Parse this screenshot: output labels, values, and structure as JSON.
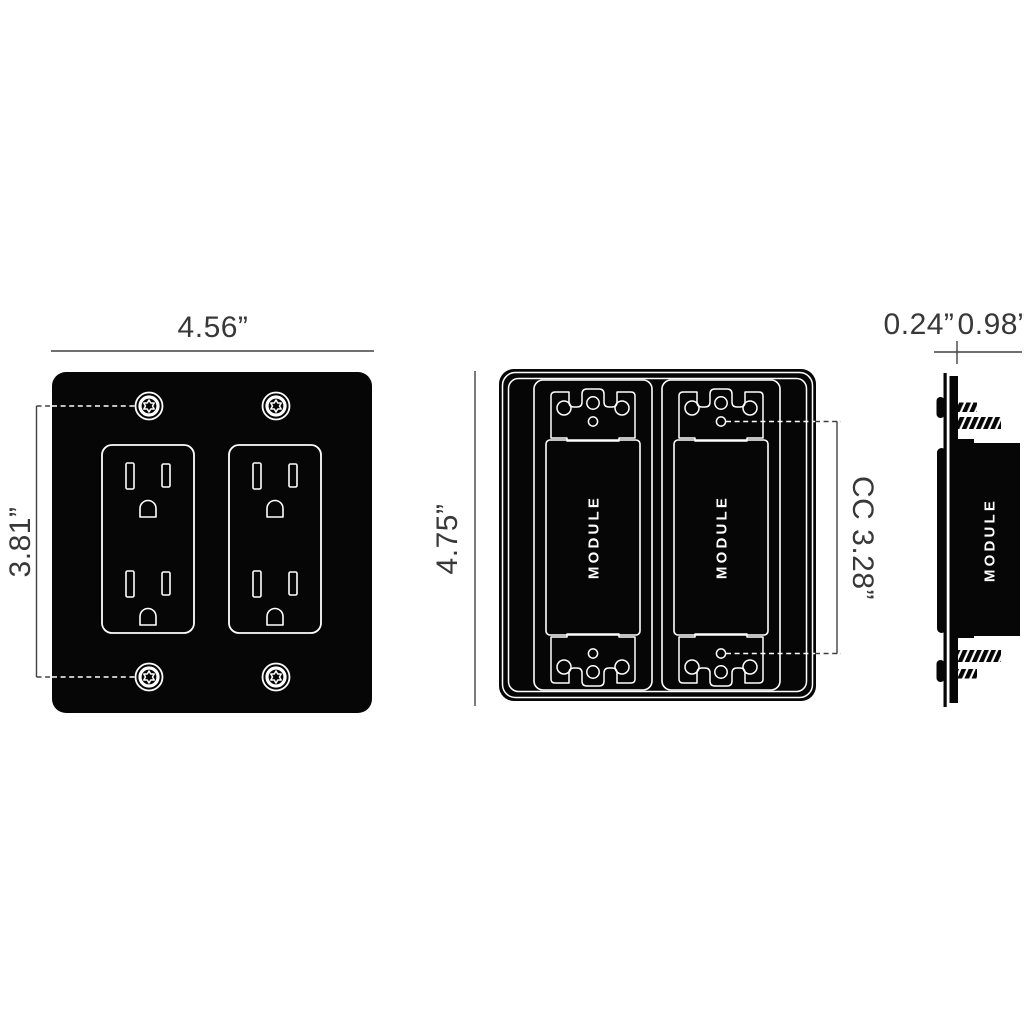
{
  "diagram_title": "wall-plate-dimension-drawing",
  "views": {
    "front": {
      "description": "front view of 2-gang black wall plate with two duplex outlets and four torx screws",
      "width_dim": "4.56”",
      "screw_spacing_dim": "3.81”"
    },
    "rear": {
      "description": "rear view of plate with two rocker module openings",
      "height_dim": "4.75”",
      "cc_dim": "CC 3.28”",
      "module_left_label": "MODULE",
      "module_right_label": "MODULE"
    },
    "side": {
      "description": "side profile showing plate thickness and module depth with mounting screws",
      "plate_thickness_dim": "0.24”",
      "module_depth_dim": "0.98”",
      "module_label": "MODULE"
    }
  },
  "colors": {
    "background": "#ffffff",
    "plate_black": "#060606",
    "outline_white": "#ffffff",
    "dimension_text": "#383838",
    "dimension_line": "#414141"
  }
}
